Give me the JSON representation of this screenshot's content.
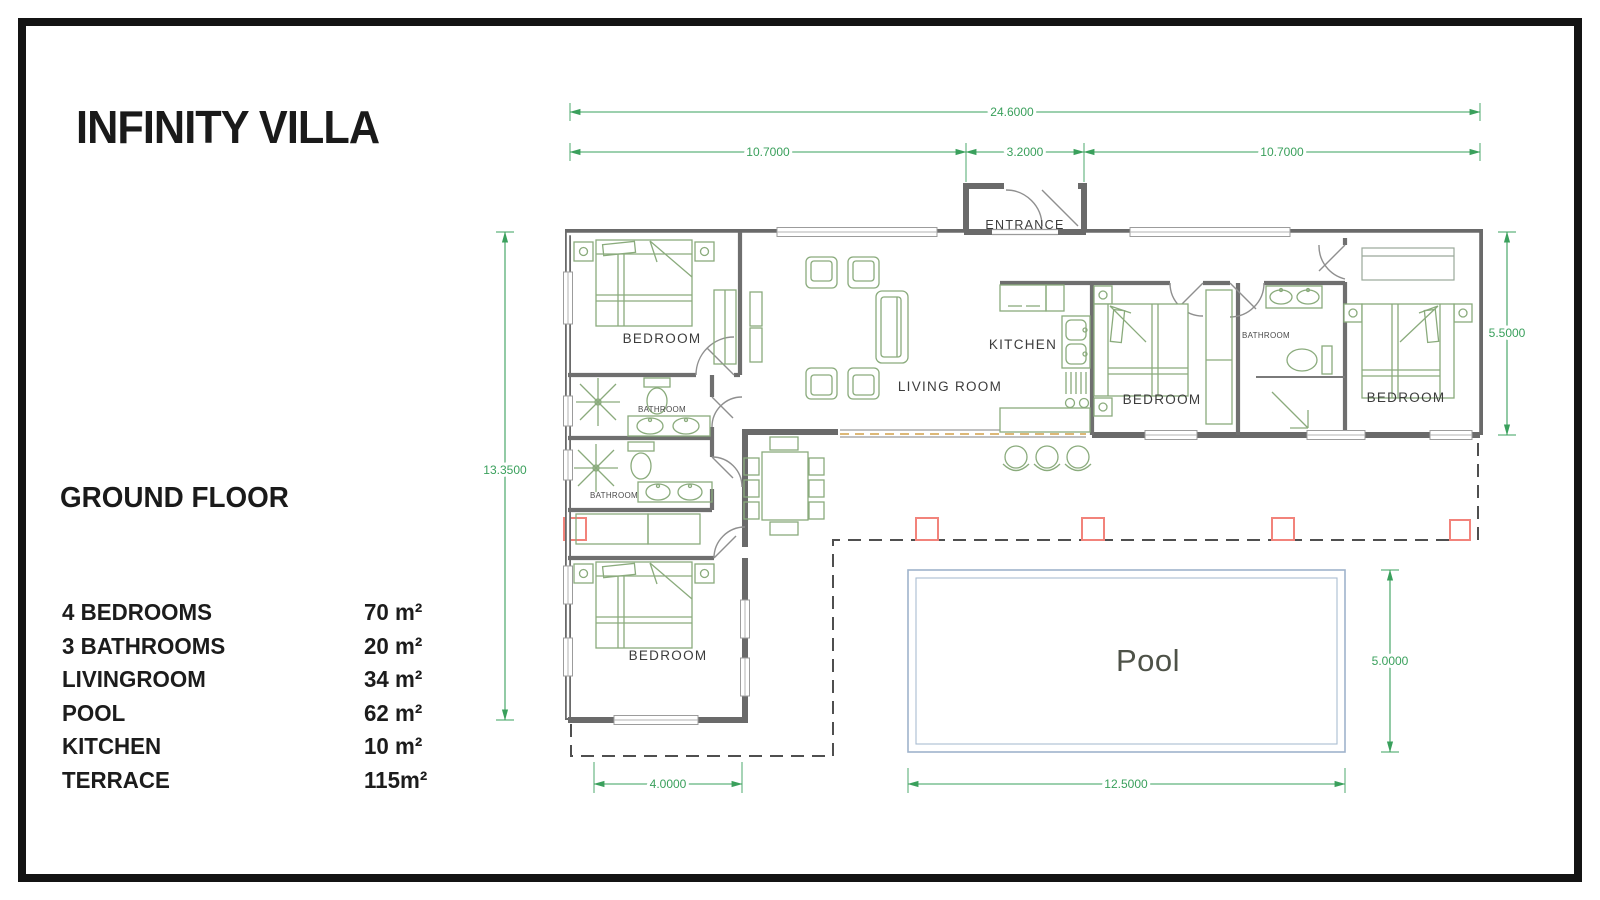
{
  "title": "INFINITY VILLA",
  "floor_label": "GROUND FLOOR",
  "legend": {
    "rows": [
      {
        "label": "4 BEDROOMS",
        "value": "70 m²"
      },
      {
        "label": "3 BATHROOMS",
        "value": "20 m²"
      },
      {
        "label": "LIVINGROOM",
        "value": "34 m²"
      },
      {
        "label": "POOL",
        "value": "62 m²"
      },
      {
        "label": "KITCHEN",
        "value": "10 m²"
      },
      {
        "label": "TERRACE",
        "value": "115m²"
      }
    ]
  },
  "plan": {
    "labels": {
      "entrance": "ENTRANCE",
      "kitchen": "KITCHEN",
      "living_room": "LIVING ROOM",
      "bedroom": "BEDROOM",
      "bathroom": "BATHROOM",
      "pool": "Pool"
    },
    "dims": {
      "total_width": "24.6000",
      "left_section": "10.7000",
      "entrance_width": "3.2000",
      "right_section": "10.7000",
      "left_height": "13.3500",
      "right_height": "5.5000",
      "pool_height": "5.0000",
      "bedroom_width": "4.0000",
      "pool_width": "12.5000"
    },
    "colors": {
      "dimension_green": "#3aa05c",
      "furniture_green": "#8aab7c",
      "wall_gray": "#6a6a6a",
      "terrace_dash": "#4f4f4f",
      "open_boundary_orange": "#d2a04a",
      "post_red": "#f2837b",
      "pool_blue": "#9fb3cb"
    }
  }
}
